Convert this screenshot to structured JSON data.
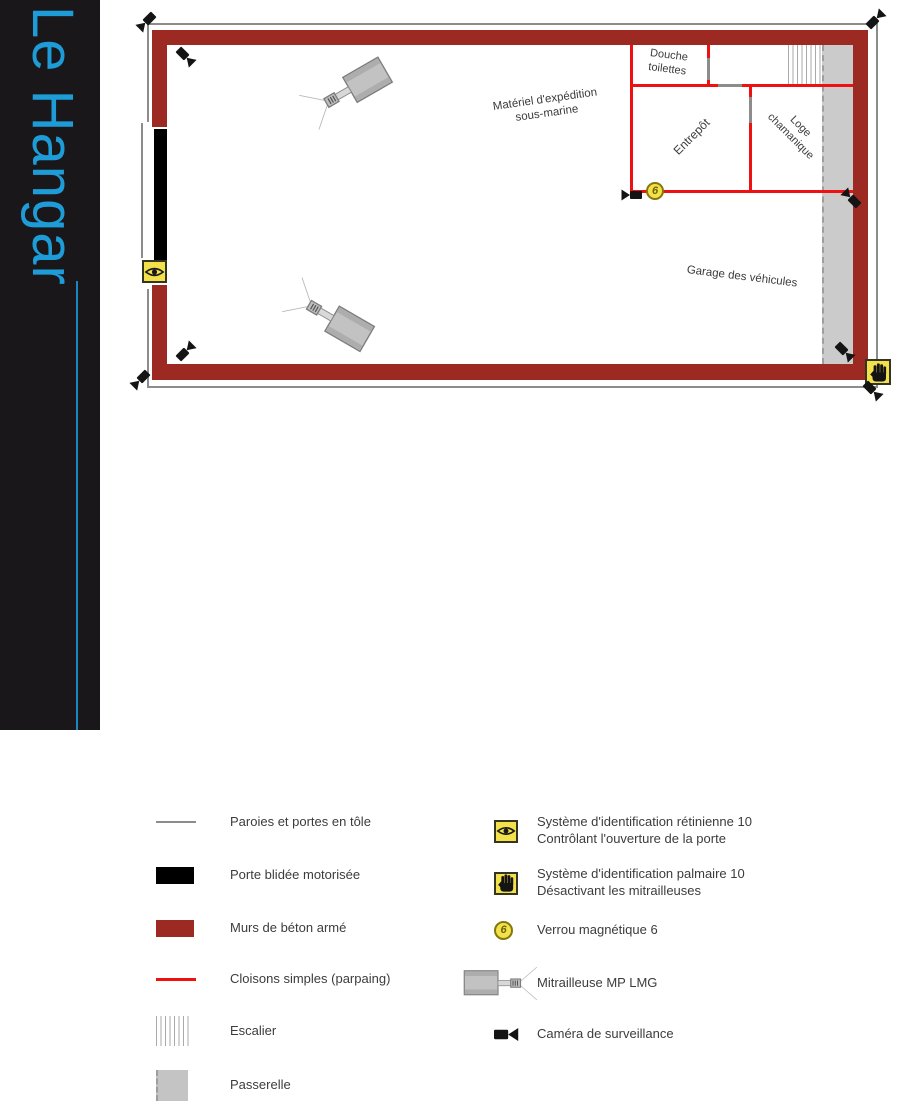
{
  "sidebar": {
    "title": "Le Hangar"
  },
  "plan": {
    "rooms": {
      "douche": "Douche\ntoilettes",
      "materiel": "Matériel d'expédition\nsous-marine",
      "entrepot": "Entrepôt",
      "loge": "Loge\nchamanique",
      "garage": "Garage des véhicules"
    },
    "lock_badge": "6"
  },
  "legend": {
    "left": [
      {
        "key": "tole",
        "label": "Paroies et portes en tôle"
      },
      {
        "key": "porte_blindee",
        "label": "Porte blidée motorisée"
      },
      {
        "key": "murs_beton",
        "label": "Murs de béton armé"
      },
      {
        "key": "cloisons",
        "label": "Cloisons simples (parpaing)"
      },
      {
        "key": "escalier",
        "label": "Escalier"
      },
      {
        "key": "passerelle",
        "label": "Passerelle"
      }
    ],
    "right": [
      {
        "key": "retinienne",
        "label": "Système d'identification rétinienne 10\nContrôlant l'ouverture de la porte"
      },
      {
        "key": "palmaire",
        "label": "Système d'identification palmaire 10\nDésactivant les mitrailleuses"
      },
      {
        "key": "verrou",
        "badge": "6",
        "label": "Verrou magnétique 6"
      },
      {
        "key": "mitrailleuse",
        "label": "Mitrailleuse MP LMG"
      },
      {
        "key": "camera",
        "label": "Caméra de surveillance"
      }
    ]
  },
  "colors": {
    "accent_blue": "#1e9cd8",
    "sidebar_black": "#19171a",
    "wall_red": "#9c2a23",
    "partition_red": "#ee1111",
    "badge_yellow": "#f2e14b"
  }
}
